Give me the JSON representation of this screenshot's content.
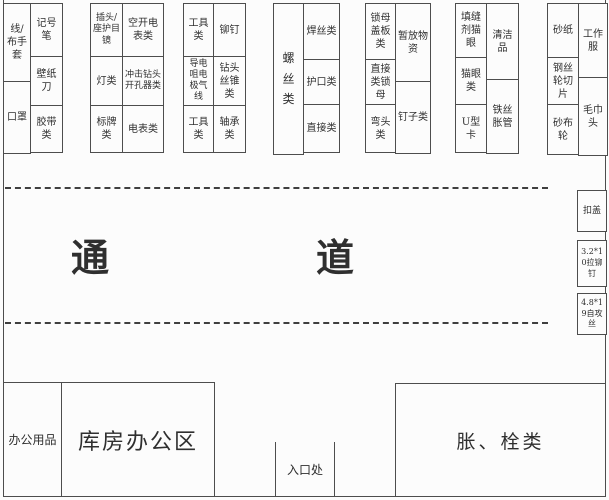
{
  "plan": {
    "groups": [
      {
        "columns": [
          {
            "cells": [
              {
                "label": "线/布手套"
              },
              {
                "label": "口罩"
              }
            ]
          },
          {
            "cells": [
              {
                "label": "记号笔"
              },
              {
                "label": "壁纸刀"
              },
              {
                "label": "胶带类"
              }
            ]
          }
        ]
      },
      {
        "columns": [
          {
            "cells": [
              {
                "label": "插头/座护目镜"
              },
              {
                "label": "灯类"
              },
              {
                "label": "标牌类"
              }
            ]
          },
          {
            "cells": [
              {
                "label": "空开电表类"
              },
              {
                "label": "冲击钻头开孔器类"
              },
              {
                "label": "电表类"
              }
            ]
          }
        ]
      },
      {
        "columns": [
          {
            "cells": [
              {
                "label": "工具类"
              },
              {
                "label": "导电咀电极气线"
              },
              {
                "label": "工具类"
              }
            ]
          },
          {
            "cells": [
              {
                "label": "铆钉"
              },
              {
                "label": "钻头丝锥类"
              },
              {
                "label": "轴承类"
              }
            ]
          }
        ]
      },
      {
        "columns": [
          {
            "cells": [
              {
                "label": "螺丝类"
              }
            ]
          },
          {
            "cells": [
              {
                "label": "焊丝类"
              },
              {
                "label": "护口类"
              },
              {
                "label": "直接类"
              }
            ]
          }
        ]
      },
      {
        "columns": [
          {
            "cells": [
              {
                "label": "锁母盖板类"
              },
              {
                "label": "直接类锁母"
              },
              {
                "label": "弯头类"
              }
            ]
          },
          {
            "cells": [
              {
                "label": "暂放物资"
              },
              {
                "label": "钉子类"
              }
            ]
          }
        ]
      },
      {
        "columns": [
          {
            "cells": [
              {
                "label": "填缝剂猫眼"
              },
              {
                "label": "猫眼类"
              },
              {
                "label": "U型卡"
              }
            ]
          },
          {
            "cells": [
              {
                "label": "清洁品"
              },
              {
                "label": "铁丝胀管"
              }
            ]
          }
        ]
      },
      {
        "columns": [
          {
            "cells": [
              {
                "label": "砂纸"
              },
              {
                "label": "钢丝轮切片"
              },
              {
                "label": "砂布轮"
              }
            ]
          },
          {
            "cells": [
              {
                "label": "工作服"
              },
              {
                "label": "毛巾头"
              }
            ]
          }
        ]
      }
    ],
    "aisle": {
      "left_char": "通",
      "right_char": "道"
    },
    "right_rack": [
      {
        "label": "扣盖"
      },
      {
        "label": "3.2*10拉铆钉"
      },
      {
        "label": "4.8*19自攻丝"
      }
    ],
    "bottom": {
      "office_supplies_label": "办公用品",
      "warehouse_office_label": "库房办公区",
      "entrance_label": "入口处",
      "expansion_bolts_label": "胀、栓类"
    },
    "colors": {
      "wall": "#4d4d4d",
      "text": "#2f2f2f",
      "background": "#fcfcfc"
    }
  }
}
